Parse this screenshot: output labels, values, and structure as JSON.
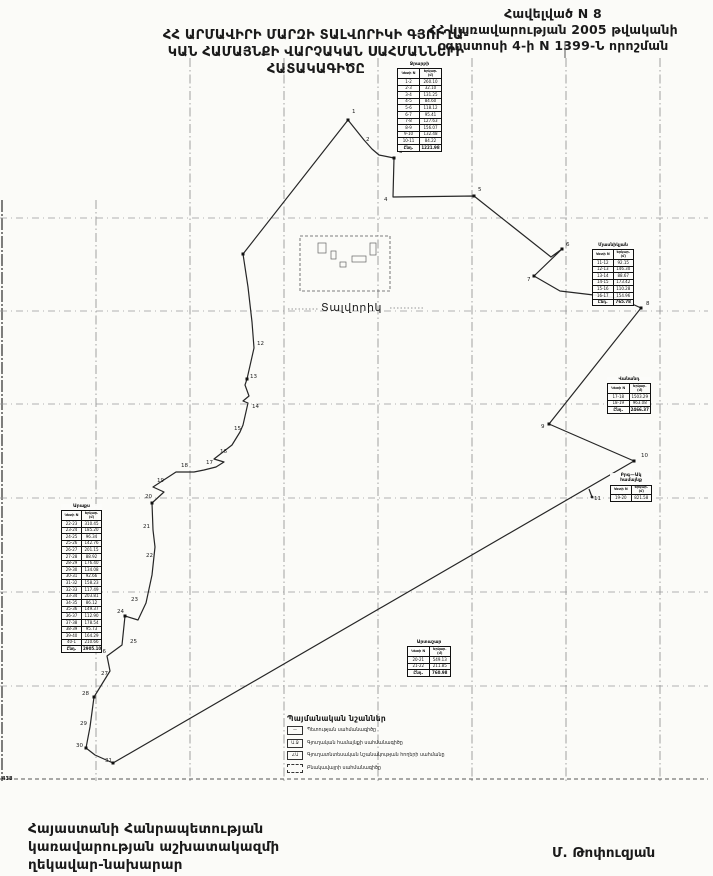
{
  "header": {
    "annex": [
      "Հավելված N 8",
      "ՀՀ կառավարության 2005 թվականի",
      "օգոստոսի 4-ի N 1399-Ն որոշման"
    ],
    "title": [
      "ՀՀ ԱՐՄԱՎԻՐԻ ՄԱՐԶԻ ՏԱԼՎՈՐԻԿԻ ԳՅՈՒՂԱ-",
      "ԿԱՆ ՀԱՄԱՅՆՔԻ ՎԱՐՉԱԿԱՆ ՍԱՀՄԱՆՆԵՐԻ",
      "ՀԱՏԱԿԱԳԻԾԸ"
    ]
  },
  "map": {
    "settlement_label": "Տալվորիկ",
    "corner_mark": "438",
    "grid": {
      "vertical_x": [
        2,
        96,
        190,
        284,
        378,
        472,
        566,
        660
      ],
      "horizontal_y": [
        218,
        311,
        404,
        498,
        592,
        686
      ],
      "bottom_y": 779,
      "top": 58,
      "bottom": 781,
      "left": 0,
      "right": 708
    },
    "boundary_points": "348,120 356,130 364,140 372,149 379,155 394,158 393,197 474,196 551,257 562,249 534,276 560,291 619,298 641,308 549,424 634,461 113,763 95,755 86,748 90,727 94,697 110,671 107,656 122,645 125,616 138,620 146,603 152,575 155,547 153,530 152,503 164,492 153,487 176,472 194,472 204,470 216,467 224,462 214,459 232,445 240,432 243,425 248,403 243,401 249,396 245,385 247,379 254,348 252,322 248,287 243,254 348,120",
    "vertex_markers": [
      [
        348,
        120
      ],
      [
        394,
        158
      ],
      [
        474,
        196
      ],
      [
        562,
        249
      ],
      [
        534,
        276
      ],
      [
        641,
        308
      ],
      [
        549,
        424
      ],
      [
        634,
        461
      ],
      [
        113,
        763
      ],
      [
        243,
        254
      ],
      [
        247,
        379
      ],
      [
        152,
        503
      ],
      [
        125,
        616
      ],
      [
        94,
        697
      ],
      [
        86,
        748
      ]
    ],
    "point_labels": [
      {
        "n": "1",
        "x": 352,
        "y": 113
      },
      {
        "n": "2",
        "x": 366,
        "y": 141
      },
      {
        "n": "3",
        "x": 399,
        "y": 153
      },
      {
        "n": "4",
        "x": 384,
        "y": 201
      },
      {
        "n": "5",
        "x": 478,
        "y": 191
      },
      {
        "n": "6",
        "x": 566,
        "y": 246
      },
      {
        "n": "7",
        "x": 527,
        "y": 281
      },
      {
        "n": "8",
        "x": 646,
        "y": 305
      },
      {
        "n": "9",
        "x": 541,
        "y": 428
      },
      {
        "n": "10",
        "x": 641,
        "y": 457
      },
      {
        "n": "11",
        "x": 594,
        "y": 500
      },
      {
        "n": "12",
        "x": 257,
        "y": 345
      },
      {
        "n": "13",
        "x": 250,
        "y": 378
      },
      {
        "n": "14",
        "x": 252,
        "y": 408
      },
      {
        "n": "15",
        "x": 234,
        "y": 430
      },
      {
        "n": "16",
        "x": 220,
        "y": 453
      },
      {
        "n": "17",
        "x": 206,
        "y": 464
      },
      {
        "n": "18",
        "x": 181,
        "y": 467
      },
      {
        "n": "19",
        "x": 157,
        "y": 482
      },
      {
        "n": "20",
        "x": 145,
        "y": 498
      },
      {
        "n": "21",
        "x": 143,
        "y": 528
      },
      {
        "n": "22",
        "x": 146,
        "y": 557
      },
      {
        "n": "23",
        "x": 131,
        "y": 601
      },
      {
        "n": "24",
        "x": 117,
        "y": 613
      },
      {
        "n": "25",
        "x": 130,
        "y": 643
      },
      {
        "n": "26",
        "x": 99,
        "y": 653
      },
      {
        "n": "27",
        "x": 101,
        "y": 675
      },
      {
        "n": "28",
        "x": 82,
        "y": 695
      },
      {
        "n": "29",
        "x": 80,
        "y": 725
      },
      {
        "n": "30",
        "x": 76,
        "y": 747
      },
      {
        "n": "31",
        "x": 105,
        "y": 762
      }
    ],
    "settlement": {
      "rect": [
        300,
        236,
        90,
        55
      ],
      "buildings": [
        [
          318,
          243,
          8,
          10
        ],
        [
          331,
          251,
          5,
          8
        ],
        [
          352,
          256,
          14,
          6
        ],
        [
          370,
          243,
          6,
          12
        ],
        [
          340,
          262,
          6,
          5
        ]
      ],
      "label_x": 321,
      "label_y": 311,
      "leader_left": [
        288,
        309,
        318,
        309
      ],
      "leader_right": [
        390,
        308,
        424,
        308
      ]
    },
    "flag_marker": [
      589,
      489,
      592,
      497
    ],
    "artifact_tick": [
      565,
      42,
      565,
      58
    ]
  },
  "tables": [
    {
      "title": "Ջրարբի",
      "x": 397,
      "y": 62,
      "w": 45,
      "headers": [
        "Կետի N",
        "Երկար. (մ)"
      ],
      "rows": [
        [
          "1-2",
          "260.10"
        ],
        [
          "2-3",
          "32.10"
        ],
        [
          "3-4",
          "131.25"
        ],
        [
          "4-5",
          "84.60"
        ],
        [
          "5-6",
          "118.12"
        ],
        [
          "6-7",
          "95.41"
        ],
        [
          "7-8",
          "127.63"
        ],
        [
          "8-9",
          "156.07"
        ],
        [
          "9-10",
          "132.48"
        ],
        [
          "10-11",
          "84.22"
        ]
      ],
      "total": [
        "Ընդ.",
        "1221.98"
      ]
    },
    {
      "title": "Մյասնիկյան",
      "x": 592,
      "y": 243,
      "w": 42,
      "headers": [
        "Կետի N",
        "Երկար. (մ)"
      ],
      "rows": [
        [
          "11-12",
          "92.15"
        ],
        [
          "12-13",
          "146.30"
        ],
        [
          "13-14",
          "88.67"
        ],
        [
          "14-15",
          "173.42"
        ],
        [
          "15-16",
          "110.28"
        ],
        [
          "16-17",
          "154.96"
        ]
      ],
      "total": [
        "Ընդ.",
        "765.78"
      ]
    },
    {
      "title": "Վանանդ",
      "x": 607,
      "y": 377,
      "w": 44,
      "headers": [
        "Կետի N",
        "Երկար. (մ)"
      ],
      "rows": [
        [
          "17-18",
          "1503.29"
        ],
        [
          "18-19",
          "963.08"
        ]
      ],
      "total": [
        "Ընդ.",
        "2466.37"
      ]
    },
    {
      "title": "Բրգ—Ակ համայնք",
      "x": 610,
      "y": 473,
      "w": 42,
      "headers": [
        "Կետի N",
        "Երկար. (մ)"
      ],
      "rows": [
        [
          "19-20",
          "821.58"
        ]
      ],
      "total": null
    },
    {
      "title": "Արտաշար",
      "x": 407,
      "y": 640,
      "w": 44,
      "headers": [
        "Կետի N",
        "Երկար. (մ)"
      ],
      "rows": [
        [
          "20-21",
          "549.13"
        ],
        [
          "21-22",
          "211.85"
        ]
      ],
      "total": [
        "Ընդ.",
        "760.98"
      ]
    },
    {
      "title": "Արաքս",
      "x": 61,
      "y": 504,
      "w": 41,
      "headers": [
        "Կետի N",
        "Երկար. (մ)"
      ],
      "rows": [
        [
          "22-23",
          "310.45"
        ],
        [
          "23-24",
          "185.20"
        ],
        [
          "24-25",
          "96.34"
        ],
        [
          "25-26",
          "142.76"
        ],
        [
          "26-27",
          "201.15"
        ],
        [
          "27-28",
          "88.92"
        ],
        [
          "28-29",
          "176.40"
        ],
        [
          "29-30",
          "134.08"
        ],
        [
          "30-31",
          "92.66"
        ],
        [
          "31-32",
          "158.23"
        ],
        [
          "32-33",
          "117.49"
        ],
        [
          "33-34",
          "203.81"
        ],
        [
          "34-35",
          "86.12"
        ],
        [
          "35-36",
          "149.37"
        ],
        [
          "36-37",
          "112.90"
        ],
        [
          "37-38",
          "178.54"
        ],
        [
          "38-39",
          "95.73"
        ],
        [
          "39-40",
          "164.29"
        ],
        [
          "40-1",
          "210.66"
        ]
      ],
      "total": [
        "Ընդ.",
        "2905.10"
      ]
    }
  ],
  "legend": {
    "title": "Պայմանական նշաններ",
    "items": [
      {
        "glyph": "—",
        "label": "Պետության սահմանագիծը"
      },
      {
        "glyph": "Ա.Ջ",
        "label": "Գյուղական համայնքի սահմանագիծը"
      },
      {
        "glyph": "∠Ա",
        "label": "Գյուղատնտեսական նշանակության հողերի սահմանը"
      },
      {
        "glyph": "",
        "label": "Բնակավայրի սահմանագիծը"
      }
    ]
  },
  "footer": {
    "left": [
      "Հայաստանի Հանրապետության",
      "կառավարության աշխատակազմի",
      "ղեկավար-նախարար"
    ],
    "right": "Մ. Թոփուզյան"
  }
}
